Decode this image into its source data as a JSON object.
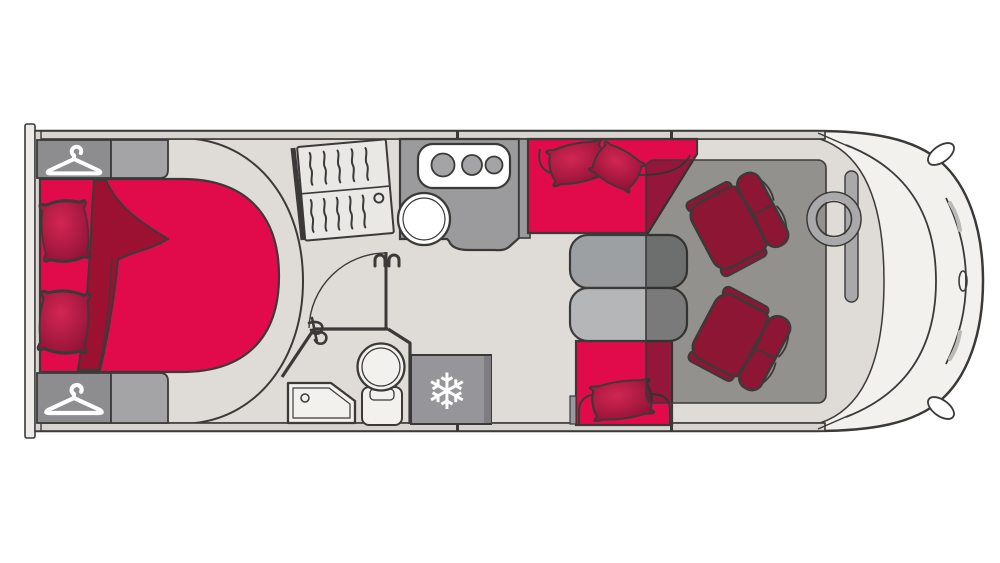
{
  "document": {
    "kind": "motorhome-floorplan-diagram"
  },
  "icons": {
    "snowflake": "❄",
    "hanger": "clothes-hanger",
    "hanger_count": 2
  },
  "colors": {
    "background": "#ffffff",
    "outline": "#3b3a39",
    "body": "#f3f1ee",
    "floor": "#dfdcd7",
    "wall": "#d7d4d0",
    "rear_panel": "#edebe8",
    "red": "#e10b4b",
    "red_dark": "#a31038",
    "blanket": "#9c1132",
    "pillow_light": "#d22653",
    "pillow_dark": "#8e1134",
    "maroon": "#8c1634",
    "cabinet_gray": "#8d8d8f",
    "cabinet_gray_light": "#a4a4a6",
    "counter_gray": "#9b9a9c",
    "stub_gray": "#9a9a9c",
    "slat_fill": "#eae8e4",
    "fridge_gray": "#96969a",
    "fridge_edge": "#7e7e82",
    "table_top": "#9da0a3",
    "table_bottom": "#b4b6b8",
    "overlay": "rgba(44,41,39,0.42)",
    "steel": "#a9a9ab",
    "fixture_white": "#f3f1ee",
    "white": "#ffffff"
  }
}
